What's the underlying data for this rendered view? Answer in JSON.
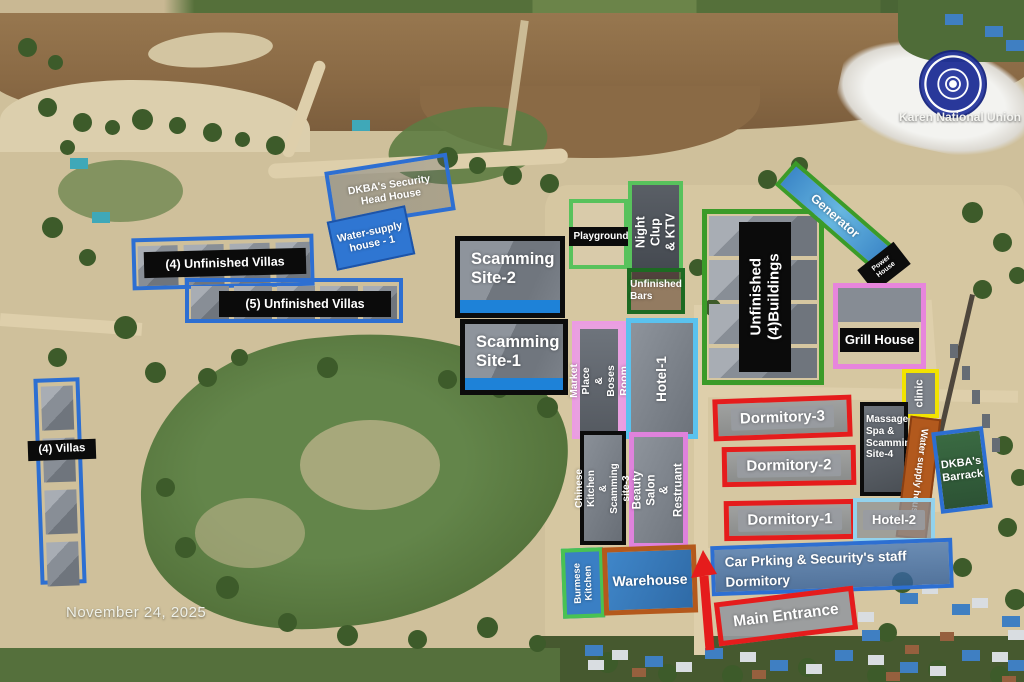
{
  "meta": {
    "date": "November 24, 2025",
    "credit": "Karen National Union"
  },
  "labels": {
    "dkba_security": "DKBA's Security\nHead House",
    "water_supply_1": "Water-supply\nhouse - 1",
    "unfinished_villas_4": "(4) Unfinished Villas",
    "unfinished_villas_5": "(5) Unfinished Villas",
    "villas_4": "(4) Villas",
    "scamming_site_2": "Scamming\nSite-2",
    "scamming_site_1": "Scamming\nSite-1",
    "playground": "Playground",
    "night_club": "Night Clup\n& KTV",
    "unfinished_bars": "Unfinished\nBars",
    "unfinished_buildings": "Unfinished\n(4)Buildings",
    "generator": "Generator",
    "power_house": "Power\nHouse",
    "grill_house": "Grill House",
    "clinic": "clinic",
    "massage_spa": "Massage\nSpa &\nScamming\nSite-4",
    "market_place": "Market Place\n& Boses Room",
    "hotel_1": "Hotel-1",
    "hotel_2": "Hotel-2",
    "dormitory_3": "Dormitory-3",
    "dormitory_2": "Dormitory-2",
    "dormitory_1": "Dormitory-1",
    "water_supply_2": "Water supply house-2",
    "dkba_barrack": "DKBA's\nBarrack",
    "chinese_kitchen": "Chinese Kitchen\n& Scamming site-3",
    "beauty_salon": "Beauty Salon\n& Restruant",
    "burmese_kitchen": "Burmese\nKitchen",
    "warehouse": "Warehouse",
    "car_parking": "Car Prking & Security's staff\nDormitory",
    "main_entrance": "Main Entrance"
  },
  "colors": {
    "annotation_blue": "#2d6fd2",
    "annotation_red": "#e51c1c",
    "annotation_green": "#58c25c",
    "annotation_dark_green": "#1d6a22",
    "annotation_pink": "#e785dc",
    "annotation_yellow": "#f2e300",
    "annotation_black": "#0c0c0c",
    "annotation_orange": "#b4591c",
    "annotation_cyan": "#5ac2ee",
    "annotation_light_blue": "#93d2ec",
    "river_brown": "#8a6a45",
    "field_green": "#55743c"
  }
}
